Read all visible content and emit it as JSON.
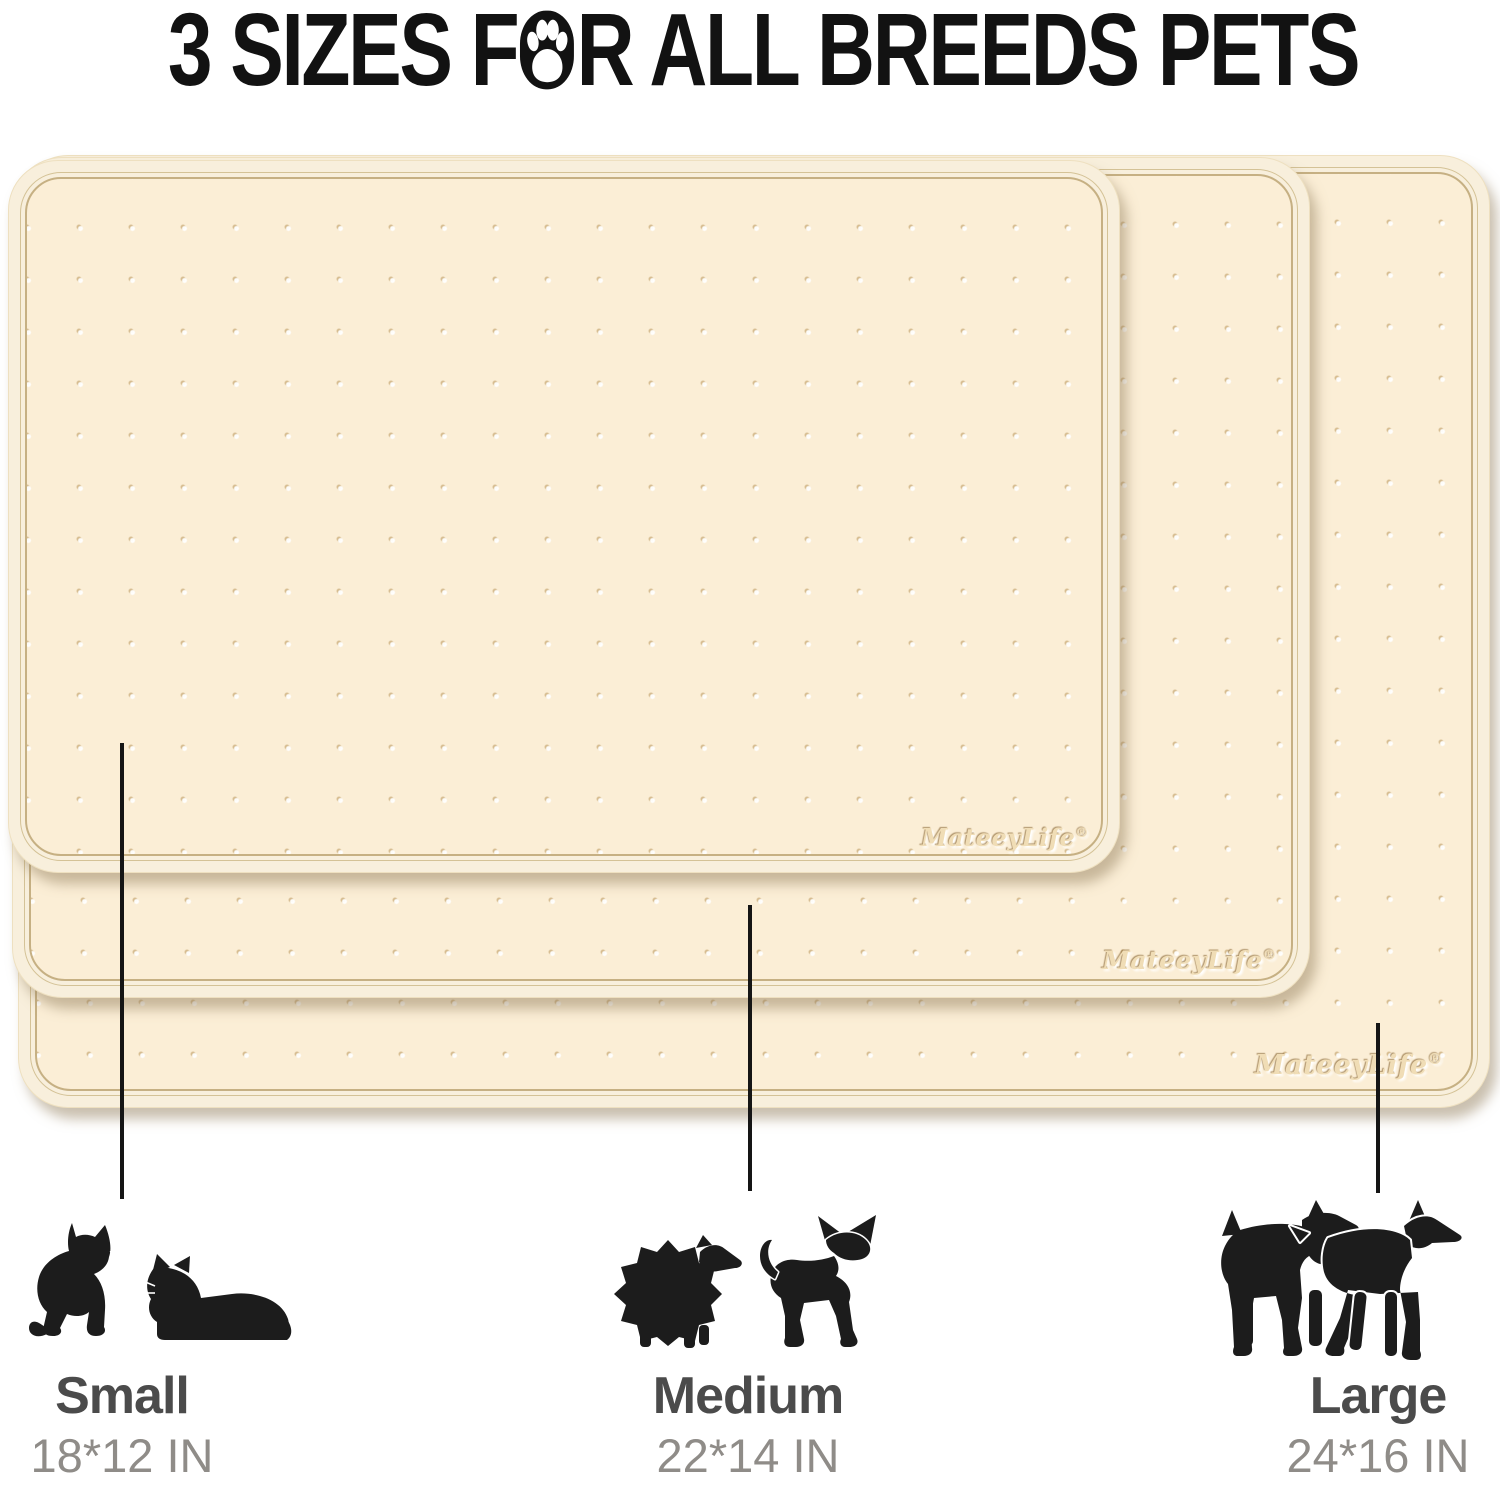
{
  "title": {
    "full": "3 SIZES FOR ALL BREEDS PETS",
    "segment_before_paw": "3 SIZES F",
    "segment_after_paw": "R ALL BREEDS PETS"
  },
  "brand": {
    "name": "MateeyLife",
    "registered_mark": "®"
  },
  "mats": [
    {
      "size_name": "Small",
      "position": "front"
    },
    {
      "size_name": "Medium",
      "position": "middle"
    },
    {
      "size_name": "Large",
      "position": "back"
    }
  ],
  "sizes": [
    {
      "label": "Small",
      "dimensions": "18*12 IN",
      "animals": [
        "sitting-cat-icon",
        "lying-cat-icon"
      ]
    },
    {
      "label": "Medium",
      "dimensions": "22*14 IN",
      "animals": [
        "pomeranian-icon",
        "chihuahua-icon"
      ]
    },
    {
      "label": "Large",
      "dimensions": "24*16 IN",
      "animals": [
        "schnauzer-icon",
        "doberman-icon"
      ]
    }
  ],
  "colors": {
    "title_text": "#121212",
    "mat_surface": "#fbeed6",
    "mat_rim_band": "#f8efdc",
    "mat_rim_line": "#c6b083",
    "mat_shadow": "rgba(150,130,95,0.5)",
    "logo_emboss": "#f0ddb6",
    "callout_line": "#151515",
    "size_label": "#4b4b4b",
    "dimension_label": "#8f8c88",
    "animal_silhouette": "#1c1c1c"
  }
}
